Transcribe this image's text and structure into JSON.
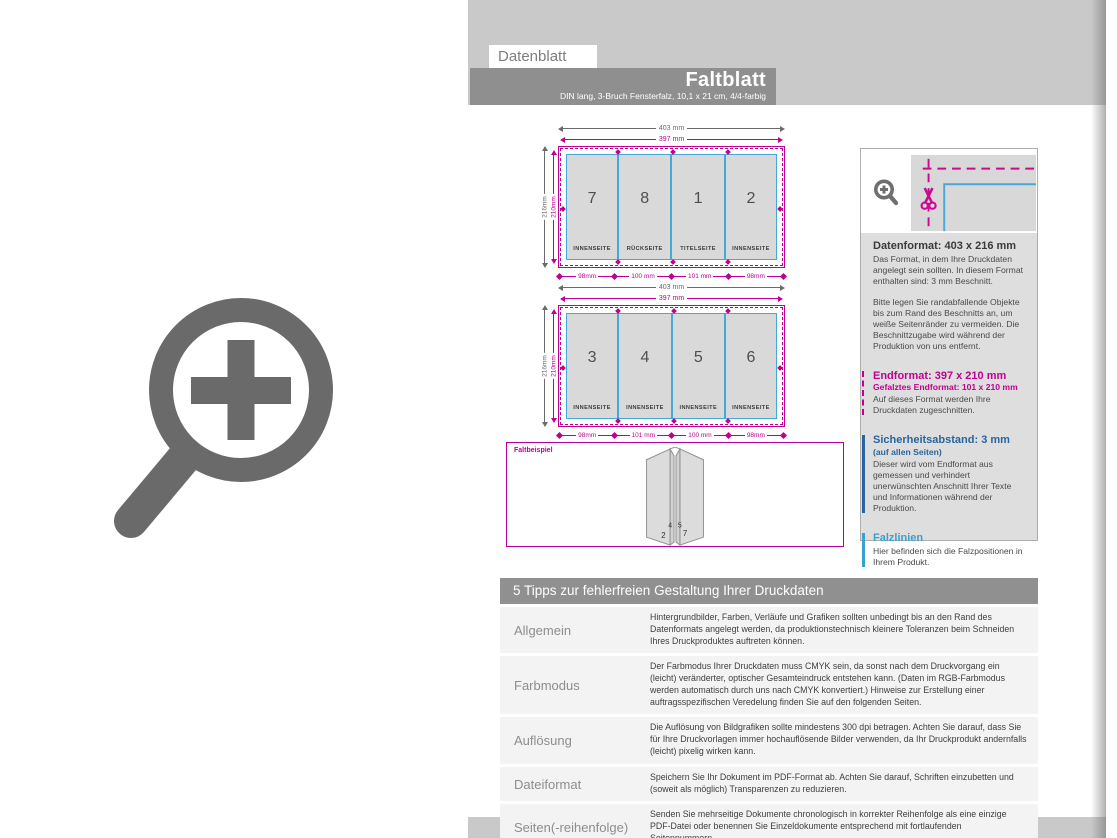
{
  "header": {
    "eyebrow": "Datenblatt",
    "title": "Faltblatt",
    "subtitle": "DIN lang, 3-Bruch Fensterfalz, 10,1 x 21 cm, 4/4-farbig"
  },
  "diagrams": [
    {
      "width_outer": "403 mm",
      "width_inner": "397 mm",
      "height_outer": "216mm",
      "height_inner": "210mm",
      "panels": [
        {
          "number": "7",
          "caption": "INNENSEITE"
        },
        {
          "number": "8",
          "caption": "RÜCKSEITE"
        },
        {
          "number": "1",
          "caption": "TITELSEITE"
        },
        {
          "number": "2",
          "caption": "INNENSEITE"
        }
      ],
      "measures": [
        "98mm",
        "100 mm",
        "101 mm",
        "98mm"
      ]
    },
    {
      "width_outer": "403 mm",
      "width_inner": "397 mm",
      "height_outer": "216mm",
      "height_inner": "210mm",
      "panels": [
        {
          "number": "3",
          "caption": "INNENSEITE"
        },
        {
          "number": "4",
          "caption": "INNENSEITE"
        },
        {
          "number": "5",
          "caption": "INNENSEITE"
        },
        {
          "number": "6",
          "caption": "INNENSEITE"
        }
      ],
      "measures": [
        "98mm",
        "101 mm",
        "100 mm",
        "98mm"
      ]
    }
  ],
  "faltbeispiel": {
    "label": "Faltbeispiel",
    "numbers": [
      "4",
      "5",
      "2",
      "7"
    ]
  },
  "sidebar": {
    "datenformat": {
      "heading": "Datenformat: 403 x 216 mm",
      "p1": "Das Format, in dem Ihre Druckdaten angelegt sein sollten. In diesem Format enthalten sind: 3 mm Beschnitt.",
      "p2": "Bitte legen Sie randabfallende Objekte bis zum Rand des Beschnitts an, um weiße Seitenränder zu vermeiden. Die Beschnittzugabe wird während der Produktion von uns entfernt."
    },
    "endformat": {
      "heading": "Endformat: 397 x 210 mm",
      "sub": "Gefalztes Endformat: 101 x 210 mm",
      "p": "Auf dieses Format werden Ihre Druckdaten zugeschnitten."
    },
    "sicherheitsabstand": {
      "heading": "Sicherheitsabstand: 3 mm",
      "sub": "(auf allen Seiten)",
      "p": "Dieser wird vom Endformat aus gemessen und verhindert unerwünschten Anschnitt Ihrer Texte und Informationen während der Produktion."
    },
    "falzlinien": {
      "heading": "Falzlinien",
      "p": "Hier befinden sich die Falzpositionen in Ihrem Produkt."
    }
  },
  "tips": {
    "header": "5 Tipps zur fehlerfreien Gestaltung Ihrer Druckdaten",
    "rows": [
      {
        "label": "Allgemein",
        "desc": "Hintergrundbilder, Farben, Verläufe und Grafiken sollten unbedingt bis an den Rand des Datenformats angelegt werden, da produktionstechnisch kleinere Toleranzen beim Schneiden Ihres Druckproduktes auftreten können."
      },
      {
        "label": "Farbmodus",
        "desc": "Der Farbmodus Ihrer Druckdaten muss CMYK sein, da sonst nach dem Druckvorgang ein (leicht) veränderter, optischer Gesamteindruck entstehen kann. (Daten im RGB-Farbmodus werden automatisch durch uns nach CMYK konvertiert.) Hinweise zur Erstellung einer auftragsspezifischen Veredelung finden Sie auf den folgenden Seiten."
      },
      {
        "label": "Auflösung",
        "desc": "Die Auflösung von Bildgrafiken sollte mindestens 300 dpi betragen. Achten Sie darauf, dass Sie für Ihre Druckvorlagen immer hochauflösende Bilder verwenden, da Ihr Druckprodukt andernfalls (leicht) pixelig wirken kann."
      },
      {
        "label": "Dateiformat",
        "desc": "Speichern Sie Ihr Dokument im PDF-Format ab. Achten Sie darauf, Schriften einzubetten und (soweit als möglich) Transparenzen zu reduzieren."
      },
      {
        "label": "Seiten(-reihenfolge)",
        "desc": "Senden Sie mehrseitige Dokumente chronologisch in korrekter Reihenfolge als eine einzige PDF-Datei oder benennen Sie Einzeldokumente entsprechend mit fortlaufenden Seitennummern."
      }
    ]
  },
  "icons": {
    "big_left": "magnifier-plus",
    "sidebar_small": "magnifier-plus",
    "sidebar_scissors": "scissors",
    "fold_marks": "diamond"
  },
  "colors": {
    "magenta": "#c0008f",
    "fold_line_blue": "#45a8d6",
    "safety_blue": "#2a649e",
    "falz_blue": "#3ba0d0",
    "panel_gray": "#d9d9d9",
    "band_gray": "#c9c9c9",
    "bar_gray": "#8f8f8f"
  }
}
